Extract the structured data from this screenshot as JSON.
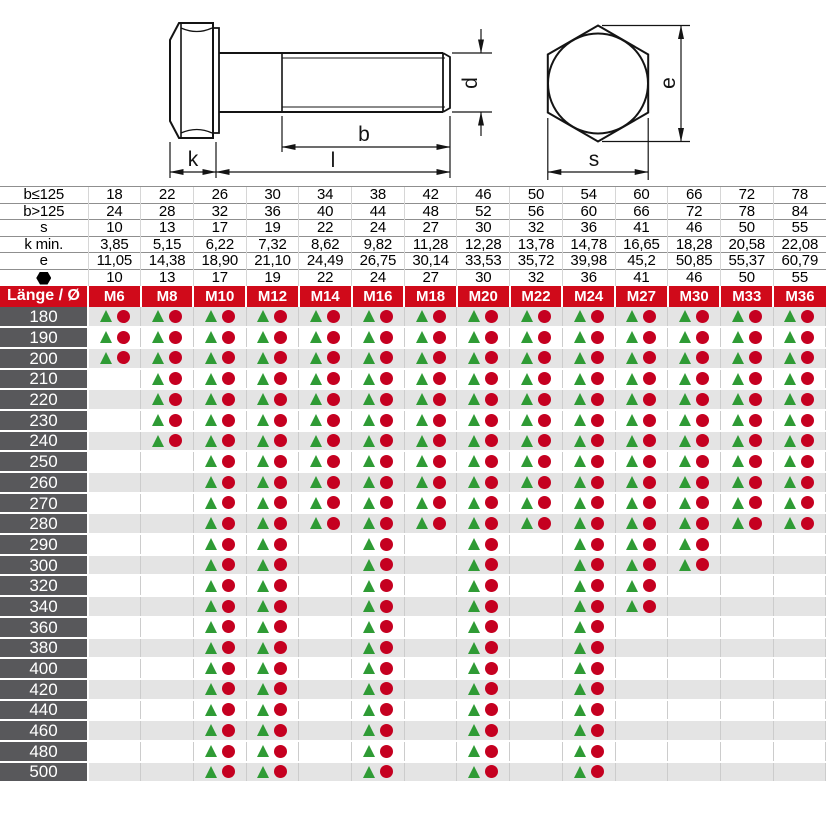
{
  "drawing": {
    "side_view": {
      "k": "k",
      "l": "l",
      "b": "b",
      "d": "d"
    },
    "head_view": {
      "s": "s",
      "e": "e"
    }
  },
  "spec_table": {
    "rows": [
      {
        "label": "b≤125",
        "values": [
          "18",
          "22",
          "26",
          "30",
          "34",
          "38",
          "42",
          "46",
          "50",
          "54",
          "60",
          "66",
          "72",
          "78"
        ]
      },
      {
        "label": "b>125",
        "values": [
          "24",
          "28",
          "32",
          "36",
          "40",
          "44",
          "48",
          "52",
          "56",
          "60",
          "66",
          "72",
          "78",
          "84"
        ]
      },
      {
        "label": "s",
        "values": [
          "10",
          "13",
          "17",
          "19",
          "22",
          "24",
          "27",
          "30",
          "32",
          "36",
          "41",
          "46",
          "50",
          "55"
        ]
      },
      {
        "label": "k min.",
        "values": [
          "3,85",
          "5,15",
          "6,22",
          "7,32",
          "8,62",
          "9,82",
          "11,28",
          "12,28",
          "13,78",
          "14,78",
          "16,65",
          "18,28",
          "20,58",
          "22,08"
        ]
      },
      {
        "label": "e",
        "values": [
          "11,05",
          "14,38",
          "18,90",
          "21,10",
          "24,49",
          "26,75",
          "30,14",
          "33,53",
          "35,72",
          "39,98",
          "45,2",
          "50,85",
          "55,37",
          "60,79"
        ]
      },
      {
        "label": "",
        "icon": "hexagon-icon",
        "values": [
          "10",
          "13",
          "17",
          "19",
          "22",
          "24",
          "27",
          "30",
          "32",
          "36",
          "41",
          "46",
          "50",
          "55"
        ]
      }
    ]
  },
  "matrix": {
    "corner_label": "Länge / Ø",
    "columns": [
      "M6",
      "M8",
      "M10",
      "M12",
      "M14",
      "M16",
      "M18",
      "M20",
      "M22",
      "M24",
      "M27",
      "M30",
      "M33",
      "M36"
    ],
    "rows": [
      {
        "length": "180",
        "available": [
          1,
          1,
          1,
          1,
          1,
          1,
          1,
          1,
          1,
          1,
          1,
          1,
          1,
          1
        ]
      },
      {
        "length": "190",
        "available": [
          1,
          1,
          1,
          1,
          1,
          1,
          1,
          1,
          1,
          1,
          1,
          1,
          1,
          1
        ]
      },
      {
        "length": "200",
        "available": [
          1,
          1,
          1,
          1,
          1,
          1,
          1,
          1,
          1,
          1,
          1,
          1,
          1,
          1
        ]
      },
      {
        "length": "210",
        "available": [
          0,
          1,
          1,
          1,
          1,
          1,
          1,
          1,
          1,
          1,
          1,
          1,
          1,
          1
        ]
      },
      {
        "length": "220",
        "available": [
          0,
          1,
          1,
          1,
          1,
          1,
          1,
          1,
          1,
          1,
          1,
          1,
          1,
          1
        ]
      },
      {
        "length": "230",
        "available": [
          0,
          1,
          1,
          1,
          1,
          1,
          1,
          1,
          1,
          1,
          1,
          1,
          1,
          1
        ]
      },
      {
        "length": "240",
        "available": [
          0,
          1,
          1,
          1,
          1,
          1,
          1,
          1,
          1,
          1,
          1,
          1,
          1,
          1
        ]
      },
      {
        "length": "250",
        "available": [
          0,
          0,
          1,
          1,
          1,
          1,
          1,
          1,
          1,
          1,
          1,
          1,
          1,
          1
        ]
      },
      {
        "length": "260",
        "available": [
          0,
          0,
          1,
          1,
          1,
          1,
          1,
          1,
          1,
          1,
          1,
          1,
          1,
          1
        ]
      },
      {
        "length": "270",
        "available": [
          0,
          0,
          1,
          1,
          1,
          1,
          1,
          1,
          1,
          1,
          1,
          1,
          1,
          1
        ]
      },
      {
        "length": "280",
        "available": [
          0,
          0,
          1,
          1,
          1,
          1,
          1,
          1,
          1,
          1,
          1,
          1,
          1,
          1
        ]
      },
      {
        "length": "290",
        "available": [
          0,
          0,
          1,
          1,
          0,
          1,
          0,
          1,
          0,
          1,
          1,
          1,
          0,
          0
        ]
      },
      {
        "length": "300",
        "available": [
          0,
          0,
          1,
          1,
          0,
          1,
          0,
          1,
          0,
          1,
          1,
          1,
          0,
          0
        ]
      },
      {
        "length": "320",
        "available": [
          0,
          0,
          1,
          1,
          0,
          1,
          0,
          1,
          0,
          1,
          1,
          0,
          0,
          0
        ]
      },
      {
        "length": "340",
        "available": [
          0,
          0,
          1,
          1,
          0,
          1,
          0,
          1,
          0,
          1,
          1,
          0,
          0,
          0
        ]
      },
      {
        "length": "360",
        "available": [
          0,
          0,
          1,
          1,
          0,
          1,
          0,
          1,
          0,
          1,
          0,
          0,
          0,
          0
        ]
      },
      {
        "length": "380",
        "available": [
          0,
          0,
          1,
          1,
          0,
          1,
          0,
          1,
          0,
          1,
          0,
          0,
          0,
          0
        ]
      },
      {
        "length": "400",
        "available": [
          0,
          0,
          1,
          1,
          0,
          1,
          0,
          1,
          0,
          1,
          0,
          0,
          0,
          0
        ]
      },
      {
        "length": "420",
        "available": [
          0,
          0,
          1,
          1,
          0,
          1,
          0,
          1,
          0,
          1,
          0,
          0,
          0,
          0
        ]
      },
      {
        "length": "440",
        "available": [
          0,
          0,
          1,
          1,
          0,
          1,
          0,
          1,
          0,
          1,
          0,
          0,
          0,
          0
        ]
      },
      {
        "length": "460",
        "available": [
          0,
          0,
          1,
          1,
          0,
          1,
          0,
          1,
          0,
          1,
          0,
          0,
          0,
          0
        ]
      },
      {
        "length": "480",
        "available": [
          0,
          0,
          1,
          1,
          0,
          1,
          0,
          1,
          0,
          1,
          0,
          0,
          0,
          0
        ]
      },
      {
        "length": "500",
        "available": [
          0,
          0,
          1,
          1,
          0,
          1,
          0,
          1,
          0,
          1,
          0,
          0,
          0,
          0
        ]
      }
    ]
  },
  "colors": {
    "header_red": "#d00a1a",
    "row_label_gray": "#58585b",
    "row_alt_gray": "#e4e4e4",
    "triangle_green": "#2f9b35",
    "circle_red": "#c50020",
    "drawing_line": "#141414"
  }
}
